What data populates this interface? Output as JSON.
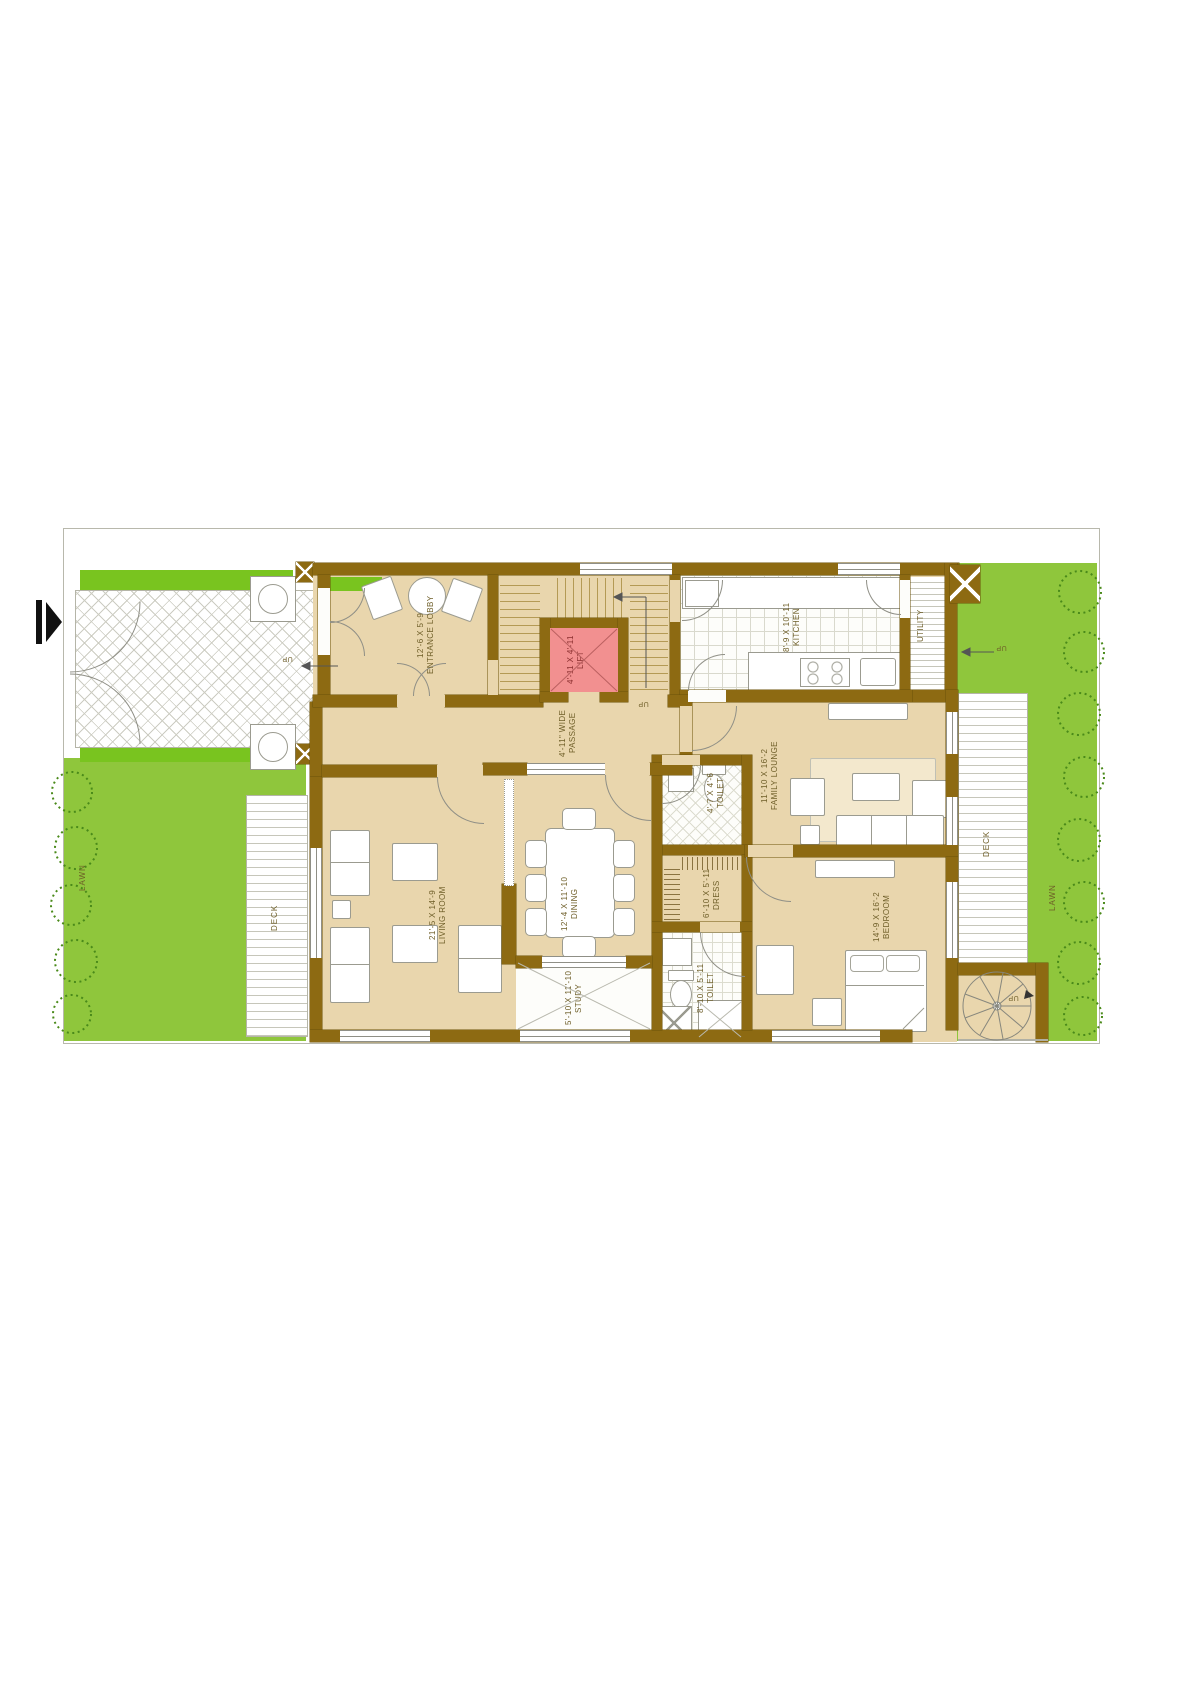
{
  "colors": {
    "wall": "#8d6a12",
    "floor": "#e9d6ad",
    "lawn": "#8fc63c",
    "lawn_bright": "#79c41f",
    "lift_fill": "#f29090",
    "line": "#8f8f86",
    "label_text": "#6e5e28",
    "bush": "#4a8a1a"
  },
  "rooms": {
    "entrance_lobby": {
      "name": "ENTRANCE LOBBY",
      "dim": "12'-6 X 5'-9"
    },
    "passage": {
      "name": "PASSAGE",
      "dim": "4'-11\" WIDE"
    },
    "lift": {
      "name": "LIFT",
      "dim": "4'-11 X 4'-11"
    },
    "kitchen": {
      "name": "KITCHEN",
      "dim": "8'-9 X 10'-11"
    },
    "utility": {
      "name": "UTILITY"
    },
    "family_lounge": {
      "name": "FAMILY LOUNGE",
      "dim": "11'-10 X 16'-2"
    },
    "toilet_1": {
      "name": "TOILET",
      "dim": "4'-7 X 4'-6"
    },
    "dress": {
      "name": "DRESS",
      "dim": "6'-10 X 5'-11"
    },
    "toilet_2": {
      "name": "TOILET",
      "dim": "8'-10 X 5'-11"
    },
    "bedroom": {
      "name": "BEDROOM",
      "dim": "14'-9 X 16'-2"
    },
    "living_room": {
      "name": "LIVING ROOM",
      "dim": "21'-5 X 14'-9"
    },
    "dining": {
      "name": "DINING",
      "dim": "12'-4 X 11'-10"
    },
    "study": {
      "name": "STUDY",
      "dim": "5'-10 X 11'-10"
    },
    "deck_left": {
      "name": "DECK"
    },
    "deck_right": {
      "name": "DECK"
    },
    "lawn_left": {
      "name": "LAWN"
    },
    "lawn_right": {
      "name": "LAWN"
    }
  },
  "markers": {
    "up": "UP"
  }
}
